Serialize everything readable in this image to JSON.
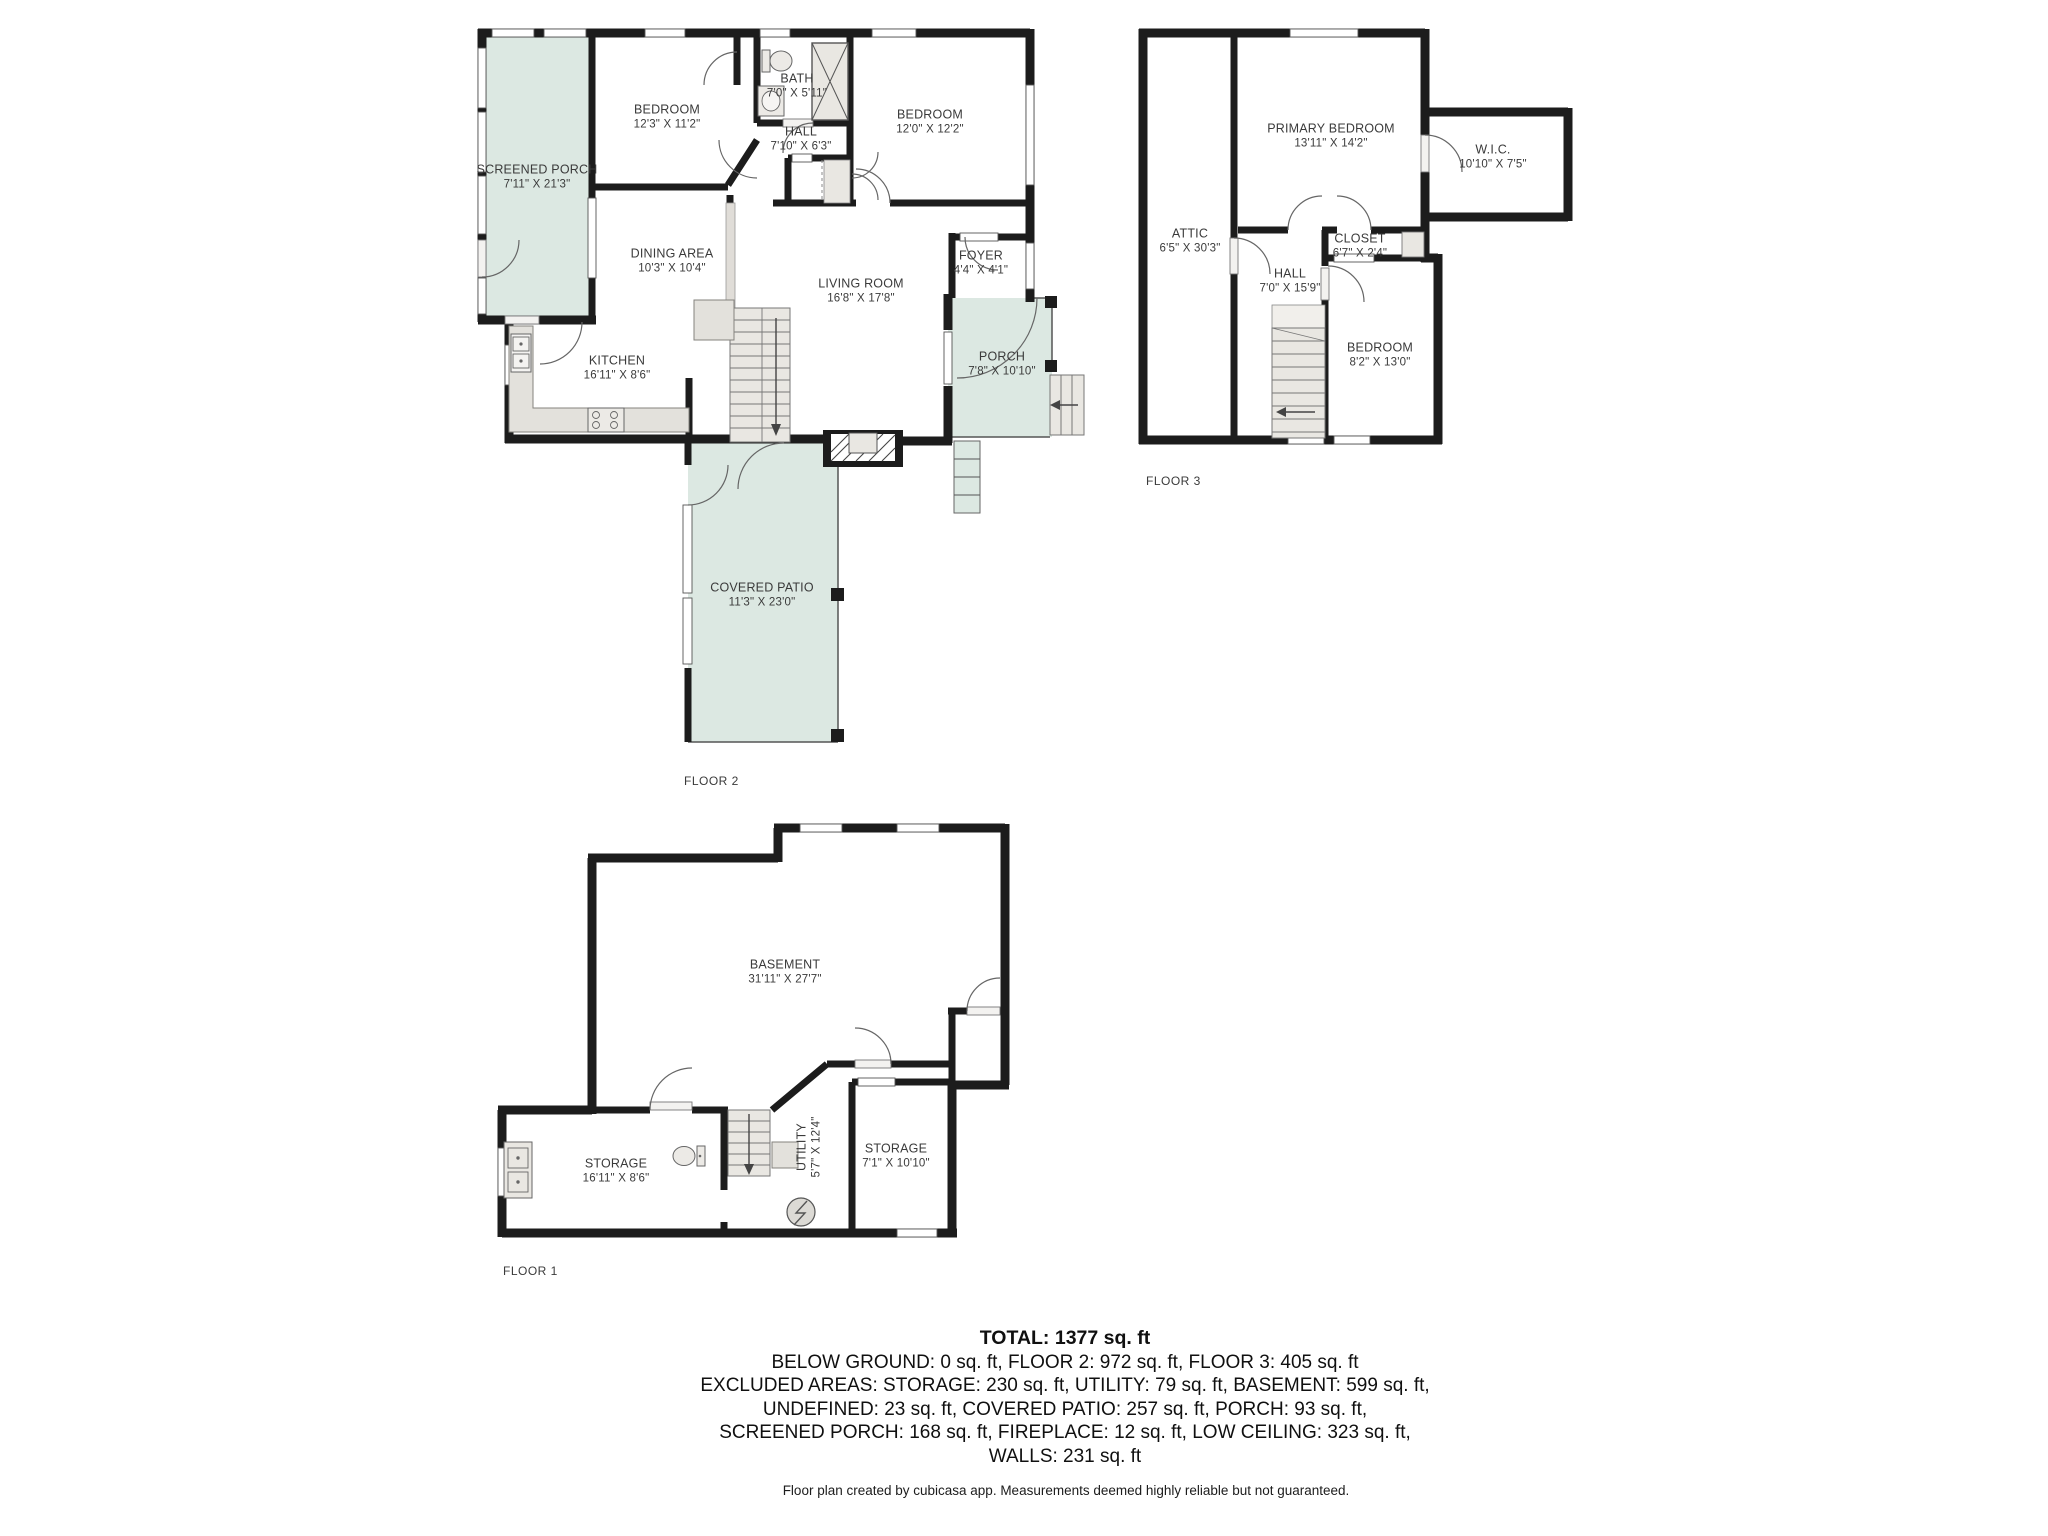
{
  "floors": {
    "floor2": {
      "label": "FLOOR 2",
      "rooms": {
        "screened_porch": {
          "name": "SCREENED PORCH",
          "dims": "7'11\" X 21'3\""
        },
        "bedroom1": {
          "name": "BEDROOM",
          "dims": "12'3\" X 11'2\""
        },
        "bath": {
          "name": "BATH",
          "dims": "7'0\" X 5'11\""
        },
        "hall": {
          "name": "HALL",
          "dims": "7'10\" X 6'3\""
        },
        "bedroom2": {
          "name": "BEDROOM",
          "dims": "12'0\" X 12'2\""
        },
        "dining": {
          "name": "DINING AREA",
          "dims": "10'3\" X 10'4\""
        },
        "living": {
          "name": "LIVING ROOM",
          "dims": "16'8\" X 17'8\""
        },
        "foyer": {
          "name": "FOYER",
          "dims": "4'4\" X 4'1\""
        },
        "porch": {
          "name": "PORCH",
          "dims": "7'8\" X 10'10\""
        },
        "kitchen": {
          "name": "KITCHEN",
          "dims": "16'11\" X 8'6\""
        },
        "covered_patio": {
          "name": "COVERED PATIO",
          "dims": "11'3\" X 23'0\""
        }
      }
    },
    "floor3": {
      "label": "FLOOR 3",
      "rooms": {
        "attic": {
          "name": "ATTIC",
          "dims": "6'5\" X 30'3\""
        },
        "primary_bedroom": {
          "name": "PRIMARY BEDROOM",
          "dims": "13'11\" X 14'2\""
        },
        "wic": {
          "name": "W.I.C.",
          "dims": "10'10\" X 7'5\""
        },
        "closet": {
          "name": "CLOSET",
          "dims": "6'7\" X 2'4\""
        },
        "hall": {
          "name": "HALL",
          "dims": "7'0\" X 15'9\""
        },
        "bedroom": {
          "name": "BEDROOM",
          "dims": "8'2\" X 13'0\""
        }
      }
    },
    "floor1": {
      "label": "FLOOR 1",
      "rooms": {
        "basement": {
          "name": "BASEMENT",
          "dims": "31'11\" X 27'7\""
        },
        "storage_left": {
          "name": "STORAGE",
          "dims": "16'11\" X 8'6\""
        },
        "utility": {
          "name": "UTILITY",
          "dims": "5'7\" X 12'4\""
        },
        "storage_right": {
          "name": "STORAGE",
          "dims": "7'1\" X 10'10\""
        }
      }
    }
  },
  "summary": {
    "total": "TOTAL: 1377 sq. ft",
    "lines": [
      "BELOW GROUND: 0 sq. ft, FLOOR 2: 972 sq. ft, FLOOR 3: 405 sq. ft",
      "EXCLUDED AREAS: STORAGE: 230 sq. ft, UTILITY: 79 sq. ft, BASEMENT: 599 sq. ft,",
      "UNDEFINED: 23 sq. ft, COVERED PATIO: 257 sq. ft, PORCH: 93 sq. ft,",
      "SCREENED PORCH: 168 sq. ft, FIREPLACE: 12 sq. ft, LOW CEILING: 323 sq. ft,",
      "WALLS: 231 sq. ft"
    ]
  },
  "footer": "Floor plan created by cubicasa app. Measurements deemed highly reliable but not guaranteed.",
  "colors": {
    "wall": "#1c1c1c",
    "porch_fill": "#dce8e2",
    "fixture_fill": "#e9e7e2",
    "text": "#3a3a3a"
  }
}
